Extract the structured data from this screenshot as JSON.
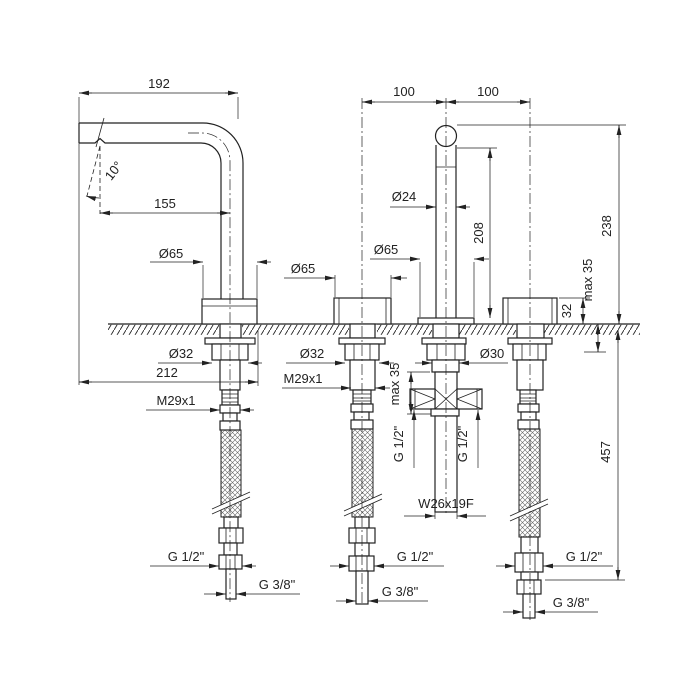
{
  "drawing": {
    "type": "faucet-installation-technical-drawing",
    "line_color": "#222222",
    "background": "#ffffff",
    "labels": {
      "dim192": "192",
      "dim155": "155",
      "angle10": "10°",
      "dia65_left": "Ø65",
      "dia65_mid": "Ø65",
      "dia65_spout": "Ø65",
      "dia24": "Ø24",
      "dim100_left": "100",
      "dim100_right": "100",
      "dim208": "208",
      "dim238": "238",
      "dim32": "32",
      "max35_spout": "max 35",
      "max35_right": "max 35",
      "dia32_left": "Ø32",
      "dia32_mid": "Ø32",
      "dia32_right": "Ø32",
      "dia30": "Ø30",
      "dim212": "212",
      "m29_left": "M29x1",
      "m29_mid": "M29x1",
      "m29_right": "M29x1",
      "g12_spout_left": "G 1/2\"",
      "g12_spout_right": "G 1/2\"",
      "w26": "W26x19F",
      "dim457": "457",
      "g12_hose_left": "G 1/2\"",
      "g12_hose_mid": "G 1/2\"",
      "g12_hose_right": "G 1/2\"",
      "g38_hose_left": "G 3/8\"",
      "g38_hose_mid": "G 3/8\"",
      "g38_hose_right": "G 3/8\""
    }
  }
}
